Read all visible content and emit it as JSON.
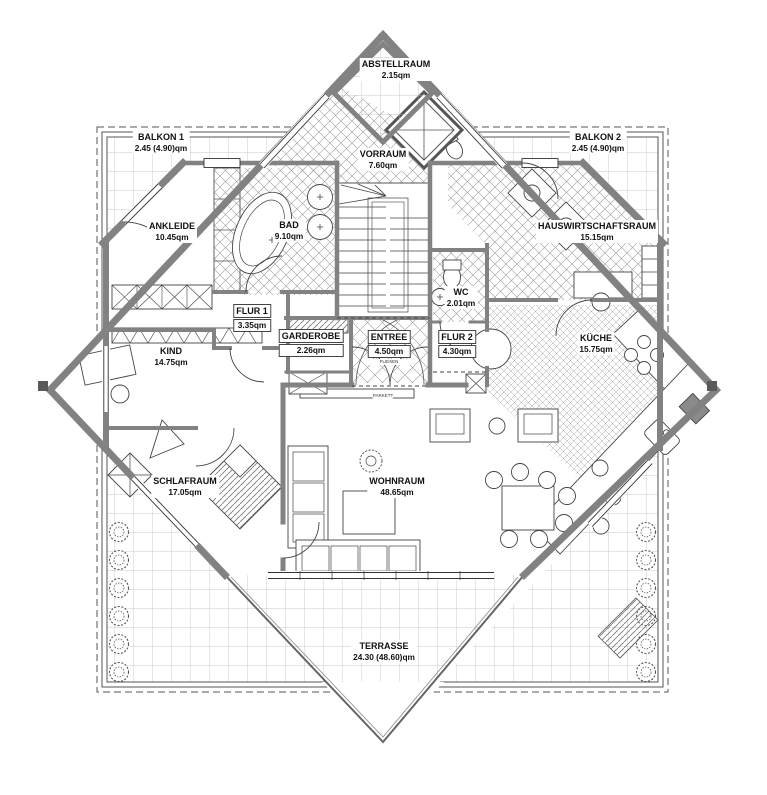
{
  "rooms": [
    {
      "name": "ABSTELLRAUM",
      "area": "2.15qm"
    },
    {
      "name": "BALKON 1",
      "area": "2.45 (4.90)qm"
    },
    {
      "name": "VORRAUM",
      "area": "7.60qm"
    },
    {
      "name": "BALKON 2",
      "area": "2.45 (4.90)qm"
    },
    {
      "name": "ANKLEIDE",
      "area": "10.45qm"
    },
    {
      "name": "BAD",
      "area": "9.10qm"
    },
    {
      "name": "HAUSWIRTSCHAFTSRAUM",
      "area": "15.15qm"
    },
    {
      "name": "FLUR 1",
      "area": "3.35qm"
    },
    {
      "name": "WC",
      "area": "2.01qm"
    },
    {
      "name": "KIND",
      "area": "14.75qm"
    },
    {
      "name": "GARDEROBE",
      "area": "2.26qm"
    },
    {
      "name": "ENTREE",
      "area": "4.50qm"
    },
    {
      "name": "FLUR 2",
      "area": "4.30qm"
    },
    {
      "name": "KÜCHE",
      "area": "15.75qm"
    },
    {
      "name": "SCHLAFRAUM",
      "area": "17.05qm"
    },
    {
      "name": "WOHNRAUM",
      "area": "48.65qm"
    },
    {
      "name": "TERRASSE",
      "area": "24.30 (48.60)qm"
    }
  ],
  "notes": {
    "entree_floor": "FLIESEN",
    "wohnraum_floor": "PARKETT"
  },
  "colors": {
    "wall": "#828282",
    "line": "#333333",
    "grid": "#b8b8b8"
  }
}
